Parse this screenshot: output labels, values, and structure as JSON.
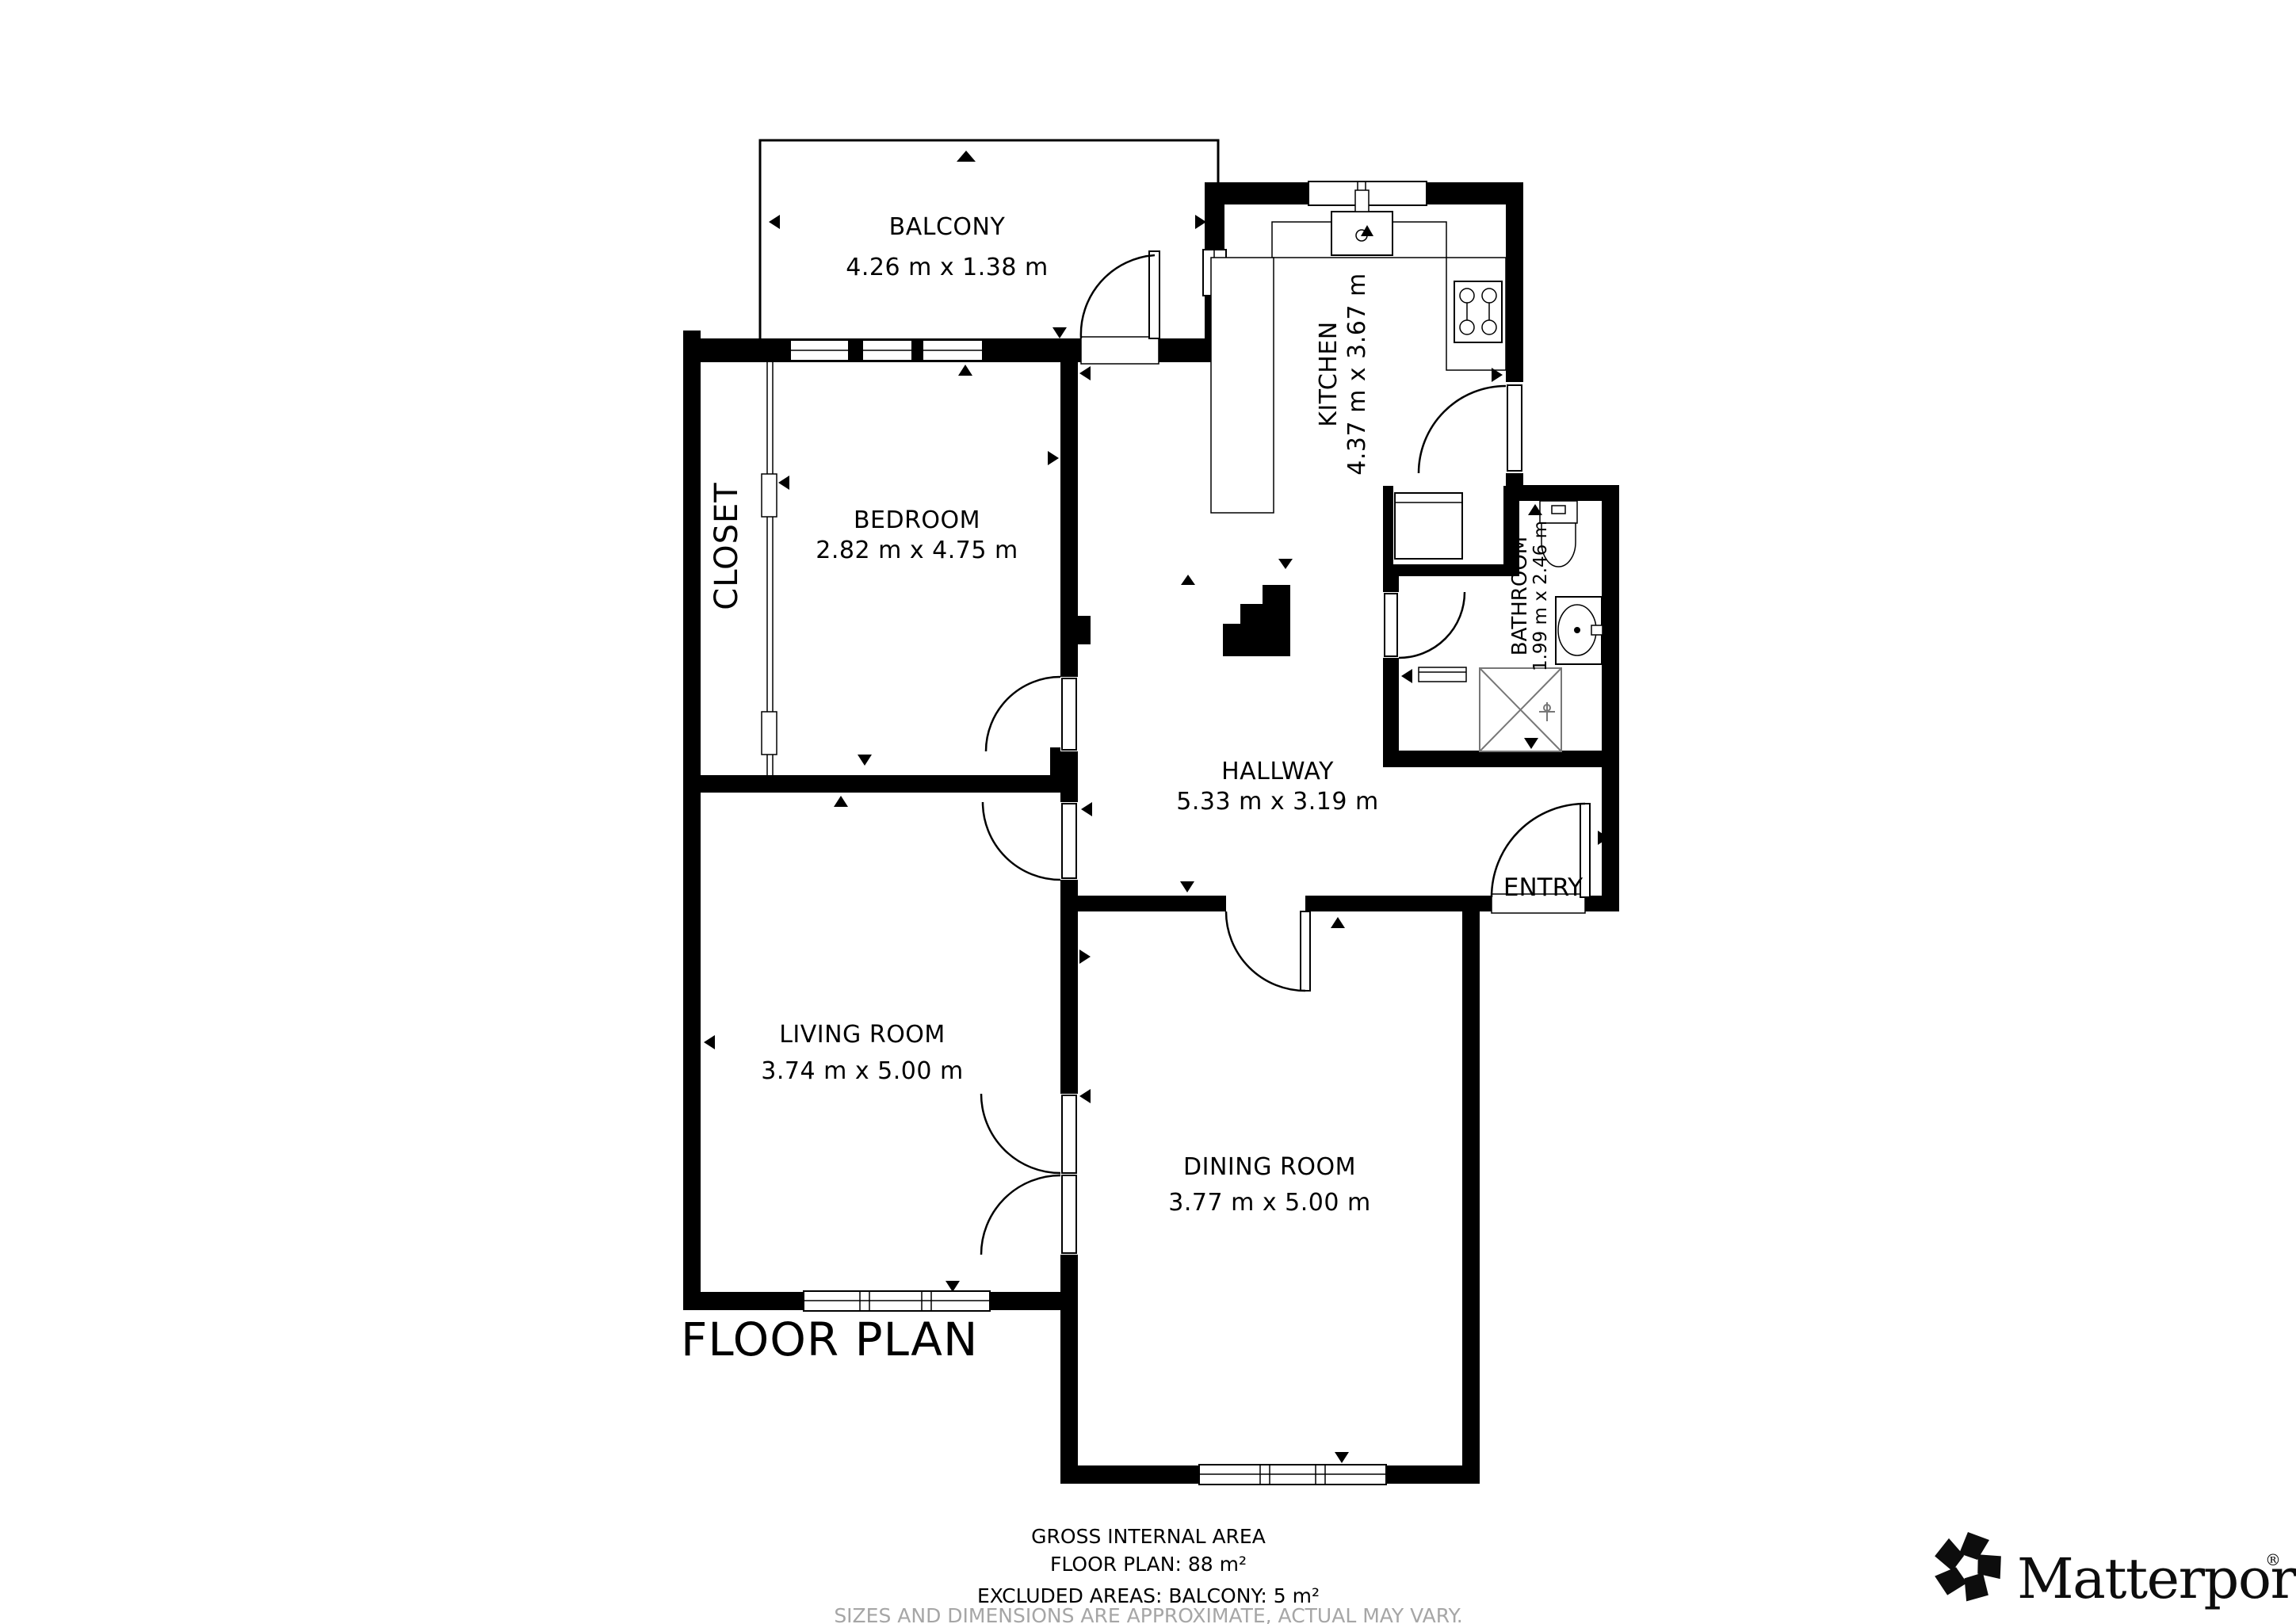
{
  "title": {
    "text": "FLOOR PLAN"
  },
  "rooms": {
    "balcony": {
      "name": "BALCONY",
      "dims": "4.26 m x 1.38 m"
    },
    "kitchen": {
      "name": "KITCHEN",
      "dims": "4.37 m x 3.67 m"
    },
    "bedroom": {
      "name": "BEDROOM",
      "dims": "2.82 m x 4.75 m"
    },
    "closet": {
      "name": "CLOSET"
    },
    "hallway": {
      "name": "HALLWAY",
      "dims": "5.33 m x 3.19 m"
    },
    "bathroom": {
      "name": "BATHROOM",
      "dims": "1.99 m x 2.46 m"
    },
    "living": {
      "name": "LIVING ROOM",
      "dims": "3.74 m x 5.00 m"
    },
    "dining": {
      "name": "DINING ROOM",
      "dims": "3.77 m x 5.00 m"
    },
    "entry": {
      "name": "ENTRY"
    }
  },
  "footer": {
    "line1": "GROSS INTERNAL AREA",
    "line2": "FLOOR PLAN: 88 m²",
    "line3": "EXCLUDED AREAS: BALCONY: 5 m²",
    "line4": "SIZES AND DIMENSIONS ARE APPROXIMATE, ACTUAL MAY VARY."
  },
  "branding": {
    "logo_text": "Matterport",
    "registered": "®"
  },
  "colors": {
    "wall": "#000000",
    "disclaimer": "#a6a6a6",
    "background": "#ffffff"
  }
}
